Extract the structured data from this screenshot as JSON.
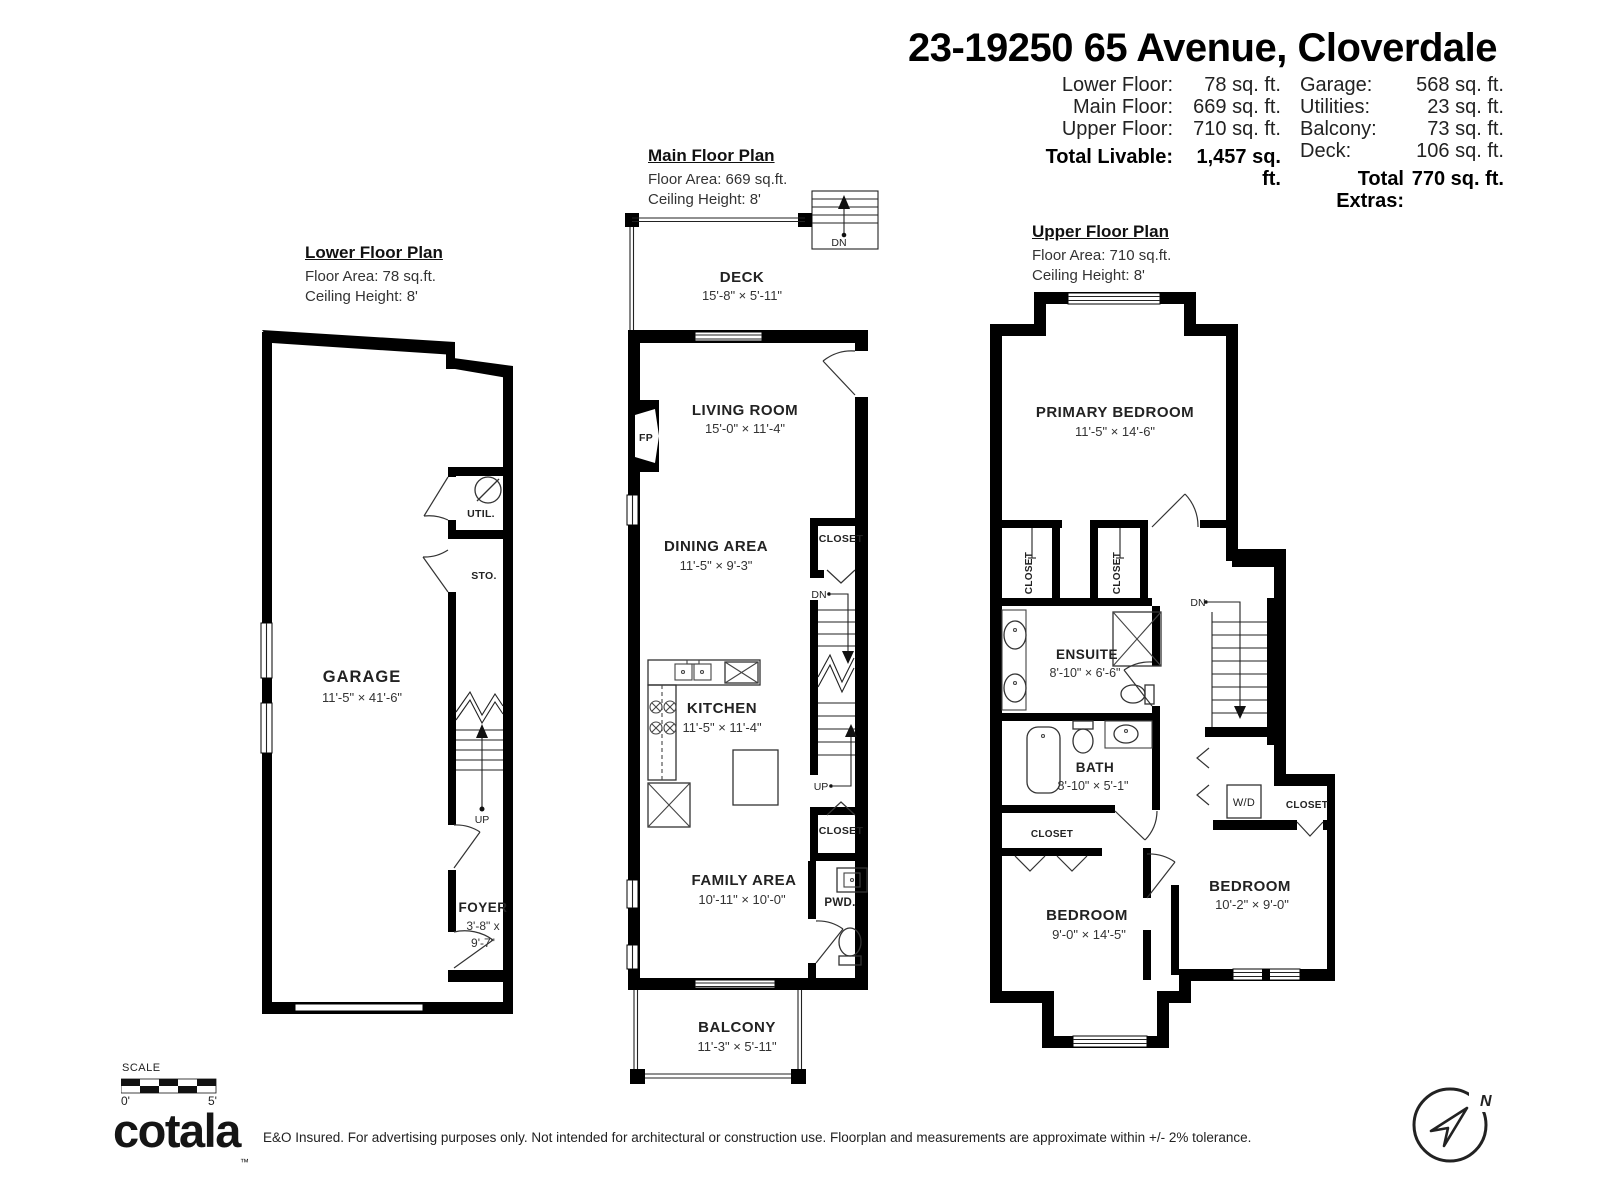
{
  "header": {
    "title": "23-19250 65 Avenue, Cloverdale"
  },
  "summary": {
    "left": [
      {
        "label": "Lower Floor:",
        "value": "78 sq. ft."
      },
      {
        "label": "Main Floor:",
        "value": "669 sq. ft."
      },
      {
        "label": "Upper Floor:",
        "value": "710 sq. ft."
      }
    ],
    "total_livable": {
      "label": "Total Livable:",
      "value": "1,457 sq. ft."
    },
    "right": [
      {
        "label": "Garage:",
        "value": "568 sq. ft."
      },
      {
        "label": "Utilities:",
        "value": "23 sq. ft."
      },
      {
        "label": "Balcony:",
        "value": "73 sq. ft."
      },
      {
        "label": "Deck:",
        "value": "106 sq. ft."
      }
    ],
    "total_extras": {
      "label": "Total Extras:",
      "value": "770 sq. ft."
    }
  },
  "plans": {
    "lower": {
      "title": "Lower Floor Plan",
      "floor_area": "Floor Area: 78 sq.ft.",
      "ceiling": "Ceiling Height: 8'",
      "stair_up": "UP",
      "rooms": {
        "garage": {
          "name": "GARAGE",
          "dims": "11'-5\" × 41'-6\""
        },
        "util": {
          "name": "UTIL."
        },
        "sto": {
          "name": "STO."
        },
        "foyer": {
          "name": "FOYER",
          "dims_line1": "3'-8\" x",
          "dims_line2": "9'-7\""
        }
      }
    },
    "main": {
      "title": "Main Floor Plan",
      "floor_area": "Floor Area: 669 sq.ft.",
      "ceiling": "Ceiling Height: 8'",
      "stair_top_dn": "DN",
      "stair_dn": "DN",
      "stair_up": "UP",
      "rooms": {
        "deck": {
          "name": "DECK",
          "dims": "15'-8\" × 5'-11\""
        },
        "living": {
          "name": "LIVING ROOM",
          "dims": "15'-0\" × 11'-4\""
        },
        "dining": {
          "name": "DINING AREA",
          "dims": "11'-5\" ×  9'-3\""
        },
        "kitchen": {
          "name": "KITCHEN",
          "dims": "11'-5\" × 11'-4\""
        },
        "family": {
          "name": "FAMILY AREA",
          "dims": "10'-11\" × 10'-0\""
        },
        "balcony": {
          "name": "BALCONY",
          "dims": "11'-3\" × 5'-11\""
        },
        "closet_upper": {
          "name": "CLOSET"
        },
        "closet_lower": {
          "name": "CLOSET"
        },
        "pwd": {
          "name": "PWD."
        },
        "fireplace": {
          "name": "FP"
        }
      }
    },
    "upper": {
      "title": "Upper Floor Plan",
      "floor_area": "Floor Area: 710 sq.ft.",
      "ceiling": "Ceiling Height: 8'",
      "stair_dn": "DN",
      "rooms": {
        "primary": {
          "name": "PRIMARY BEDROOM",
          "dims": "11'-5\" × 14'-6\""
        },
        "ensuite": {
          "name": "ENSUITE",
          "dims": "8'-10\" ×  6'-6\""
        },
        "bath": {
          "name": "BATH",
          "dims": "8'-10\" ×  5'-1\""
        },
        "bedroom_left": {
          "name": "BEDROOM",
          "dims": "9'-0\" × 14'-5\""
        },
        "bedroom_right": {
          "name": "BEDROOM",
          "dims": "10'-2\" ×  9'-0\""
        },
        "closet_a": {
          "name": "CLOSET"
        },
        "closet_b": {
          "name": "CLOSET"
        },
        "closet_c": {
          "name": "CLOSET"
        },
        "closet_d": {
          "name": "CLOSET"
        },
        "wd": {
          "name": "W/D"
        }
      }
    }
  },
  "scale": {
    "label": "SCALE",
    "start": "0'",
    "end": "5'"
  },
  "branding": {
    "logo": "cotala",
    "tm": "™"
  },
  "disclaimer": "E&O Insured. For advertising purposes only. Not intended for architectural or construction use. Floorplan and measurements are approximate within +/- 2% tolerance.",
  "compass": {
    "north": "N"
  },
  "colors": {
    "wall": "#000000",
    "background": "#ffffff",
    "text": "#222222"
  }
}
